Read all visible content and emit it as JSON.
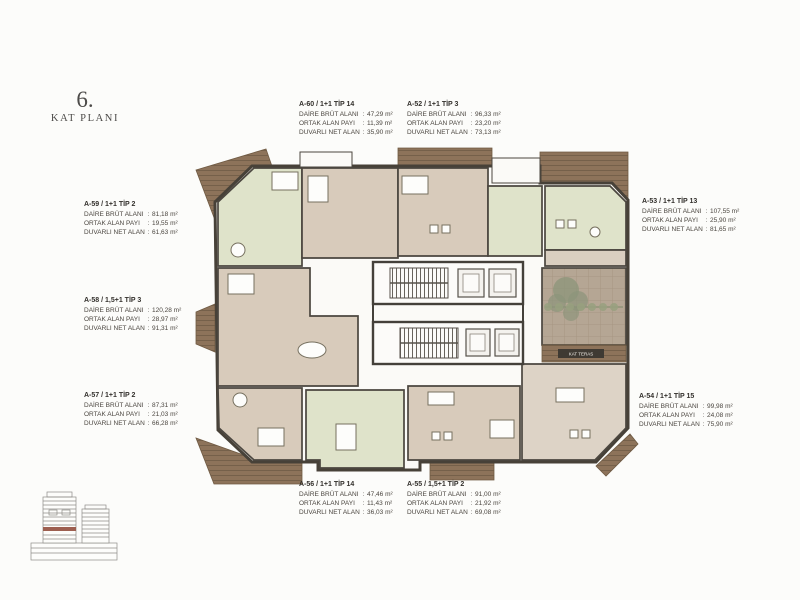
{
  "ui": {
    "colon": ":"
  },
  "title": {
    "number": "6.",
    "label": "KAT PLANI"
  },
  "plan": {
    "terrace_label": "KAT TERAS"
  },
  "row_labels": [
    "DAİRE BRÜT ALANI",
    "ORTAK ALAN PAYI",
    "DUVARLI NET ALAN"
  ],
  "units": {
    "a60": {
      "header": "A-60 / 1+1 TİP 14",
      "brut": "47,29 m²",
      "ortak": "11,39 m²",
      "net": "35,90 m²"
    },
    "a52": {
      "header": "A-52 / 1+1 TİP 3",
      "brut": "96,33 m²",
      "ortak": "23,20 m²",
      "net": "73,13 m²"
    },
    "a59": {
      "header": "A-59 / 1+1 TİP 2",
      "brut": "81,18 m²",
      "ortak": "19,55 m²",
      "net": "61,63 m²"
    },
    "a53": {
      "header": "A-53 / 1+1 TİP 13",
      "brut": "107,55 m²",
      "ortak": "25,90 m²",
      "net": "81,65 m²"
    },
    "a58": {
      "header": "A-58 / 1,5+1 TİP 3",
      "brut": "120,28 m²",
      "ortak": "28,97 m²",
      "net": "91,31 m²"
    },
    "a57": {
      "header": "A-57 / 1+1 TİP 2",
      "brut": "87,31 m²",
      "ortak": "21,03 m²",
      "net": "66,28 m²"
    },
    "a54": {
      "header": "A-54 / 1+1 TİP 15",
      "brut": "99,98 m²",
      "ortak": "24,08 m²",
      "net": "75,90 m²"
    },
    "a56": {
      "header": "A-56 / 1+1 TİP 14",
      "brut": "47,46 m²",
      "ortak": "11,43 m²",
      "net": "36,03 m²"
    },
    "a55": {
      "header": "A-55 / 1,5+1 TİP 2",
      "brut": "91,00 m²",
      "ortak": "21,92 m²",
      "net": "69,08 m²"
    }
  },
  "colors": {
    "room_green": "#dfe3ca",
    "room_tan": "#d8cbbb",
    "deck_brown": "#8d735a",
    "terrace": "#b5a694",
    "wall": "#474138",
    "floor_marker_red": "#9d5f50"
  }
}
